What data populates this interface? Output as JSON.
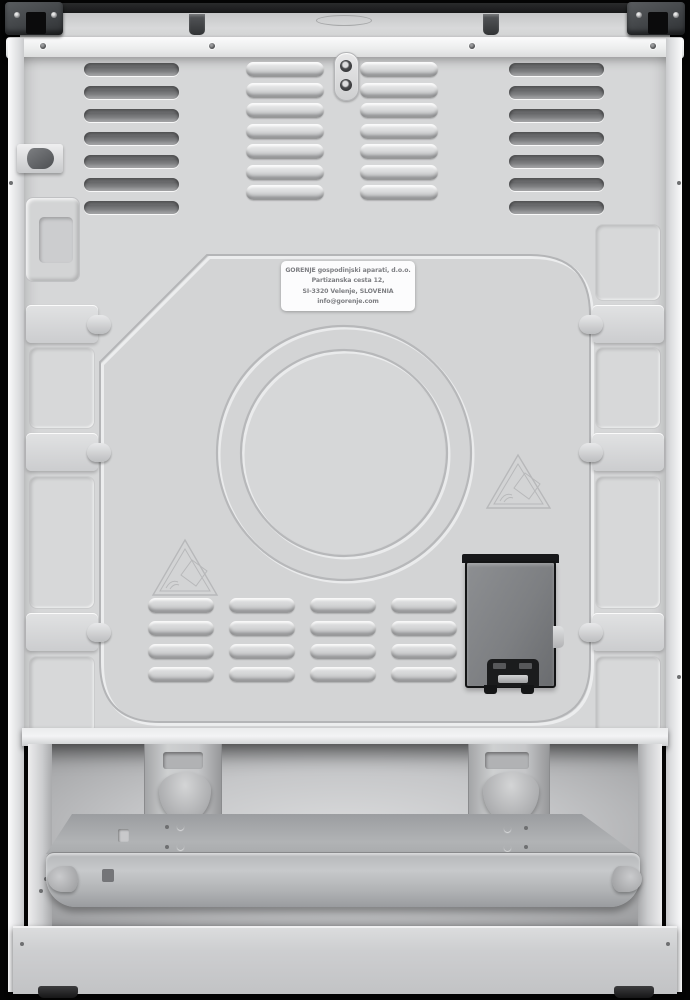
{
  "scene": {
    "description": "Rear view product photograph of a white Gorenje freestanding cooker against a black background",
    "background_color": "#040404"
  },
  "service_label": {
    "lines": [
      "GORENJE gospodinjski aparati, d.o.o.",
      "Partizanska cesta 12,",
      "SI-3320 Velenje, SLOVENIA",
      "info@gorenje.com"
    ]
  },
  "colors": {
    "background": "#040404",
    "back_panel": "#d6d7d8",
    "white_trim": "#f4f4f5",
    "label_bg": "#fcfcfd",
    "label_text": "#7d7e82",
    "terminal_box_body": "#7d7f82",
    "terminal_box_frame": "#131415",
    "tray": "#b2b4b6",
    "cooktop_edge": "#1c1d1e"
  },
  "icons": {
    "warning_triangle": "esd-warning-triangle-icon",
    "logo": "gorenje-oval-logo-emboss"
  }
}
